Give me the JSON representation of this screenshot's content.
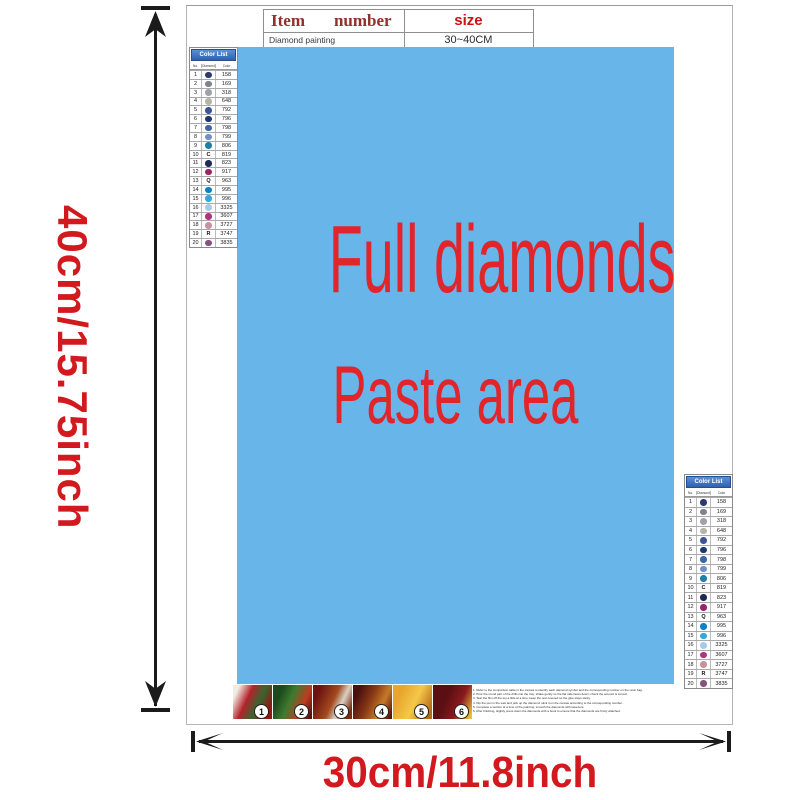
{
  "colors": {
    "paste_blue": "#67b5e9",
    "paste_text_red": "#e1252b",
    "dimension_red": "#d2191e",
    "table_header_maroon": "#93302c",
    "size_red": "#cf1116",
    "color_list_header_blue": "#3d77c8"
  },
  "dims": {
    "height_label": "40cm/15.75inch",
    "width_label": "30cm/11.8inch"
  },
  "item_table": {
    "col_item": "Item",
    "col_number": "number",
    "col_size": "size",
    "product": "Diamond painting",
    "size_value": "30~40CM"
  },
  "paste": {
    "line1": "Full diamonds",
    "line2": "Paste area"
  },
  "color_list": {
    "title": "Color List",
    "col_no": "No.",
    "col_diamond": "Diamond",
    "col_color": "Color",
    "rows": [
      {
        "no": "1",
        "sym": "",
        "sym_type": "circle",
        "hex": "#2c3a6e",
        "code": "158"
      },
      {
        "no": "2",
        "sym": "",
        "sym_type": "circle",
        "hex": "#80838b",
        "code": "169"
      },
      {
        "no": "3",
        "sym": "",
        "sym_type": "circle",
        "hex": "#a0a2a6",
        "code": "318"
      },
      {
        "no": "4",
        "sym": "",
        "sym_type": "circle",
        "hex": "#b2b5aa",
        "code": "648"
      },
      {
        "no": "5",
        "sym": "",
        "sym_type": "circle",
        "hex": "#3f5397",
        "code": "792"
      },
      {
        "no": "6",
        "sym": "",
        "sym_type": "circle",
        "hex": "#21366f",
        "code": "796"
      },
      {
        "no": "7",
        "sym": "",
        "sym_type": "circle",
        "hex": "#3d65a9",
        "code": "798"
      },
      {
        "no": "8",
        "sym": "",
        "sym_type": "circle",
        "hex": "#6f90ca",
        "code": "799"
      },
      {
        "no": "9",
        "sym": "",
        "sym_type": "circle",
        "hex": "#1e80a6",
        "code": "806"
      },
      {
        "no": "10",
        "sym": "C",
        "sym_type": "letter",
        "hex": "",
        "code": "819"
      },
      {
        "no": "11",
        "sym": "",
        "sym_type": "circle",
        "hex": "#1b2b56",
        "code": "823"
      },
      {
        "no": "12",
        "sym": "",
        "sym_type": "circle",
        "hex": "#9c2464",
        "code": "917"
      },
      {
        "no": "13",
        "sym": "Q",
        "sym_type": "letter",
        "hex": "",
        "code": "963"
      },
      {
        "no": "14",
        "sym": "",
        "sym_type": "circle",
        "hex": "#0c80c3",
        "code": "995"
      },
      {
        "no": "15",
        "sym": "",
        "sym_type": "circle",
        "hex": "#30a9db",
        "code": "996"
      },
      {
        "no": "16",
        "sym": "",
        "sym_type": "circle",
        "hex": "#a9c9e9",
        "code": "3325"
      },
      {
        "no": "17",
        "sym": "",
        "sym_type": "circle",
        "hex": "#b03380",
        "code": "3607"
      },
      {
        "no": "18",
        "sym": "",
        "sym_type": "circle",
        "hex": "#c9909f",
        "code": "3727"
      },
      {
        "no": "19",
        "sym": "R",
        "sym_type": "letter",
        "hex": "",
        "code": "3747"
      },
      {
        "no": "20",
        "sym": "",
        "sym_type": "circle",
        "hex": "#85517f",
        "code": "3835"
      }
    ]
  },
  "steps": [
    {
      "num": "1",
      "photo": "photo-1"
    },
    {
      "num": "2",
      "photo": "photo-2"
    },
    {
      "num": "3",
      "photo": "photo-3"
    },
    {
      "num": "4",
      "photo": "photo-4"
    },
    {
      "num": "5",
      "photo": "photo-5"
    },
    {
      "num": "6",
      "photo": "photo-6"
    }
  ],
  "instructions": [
    {
      "text": "1. Refer to the comparison table in the canvas to identify each diamond symbol and the corresponding number on the resin bag."
    },
    {
      "text": "2. Pour the round part of the drills into the tray; shake gently so the flat side faces down; check the amount is correct."
    },
    {
      "text": "3. Tear the film off the top a little at a time; keep the rest covered so the glue stays sticky."
    },
    {
      "text": "4. Dip the pen in the wax and pick up the diamond; stick it on the canvas according to the corresponding number."
    },
    {
      "text": "5. Complete a section at a time of the painting; smooth the diamonds with tweezers."
    },
    {
      "text": "6. After finishing, slightly press down the diamonds with a book to ensure that the diamonds are firmly attached."
    }
  ]
}
